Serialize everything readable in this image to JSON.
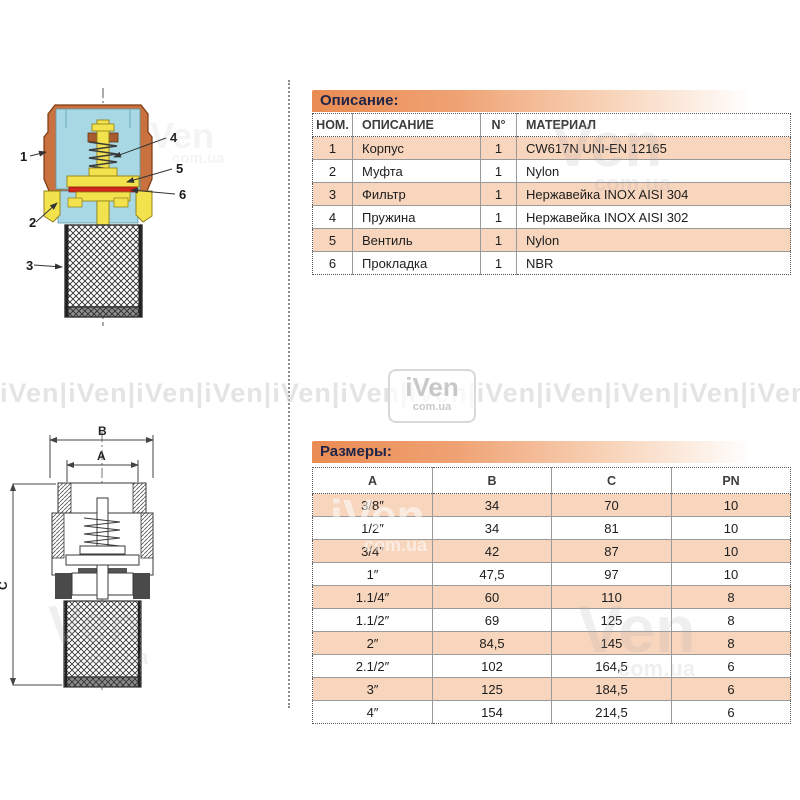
{
  "watermark": {
    "brand": "iVen",
    "short": "Ven",
    "domain": "com.ua",
    "band": "iVen|iVen|iVen|iVen|iVen|iVen|iVen|iVen|iVen|iVen|iVen|iVen|iVen|iVen"
  },
  "colors": {
    "accent_orange": "#ea8c53",
    "row_highlight": "#f8d5bd",
    "body_orange": "#c9723f",
    "interior_cyan": "#a7d8e4",
    "part_yellow": "#f2e24e",
    "gasket_red": "#d0281c",
    "title_text": "#202548"
  },
  "description_section": {
    "title": "Описание:",
    "table": {
      "columns": [
        "НОМ.",
        "ОПИСАНИЕ",
        "N°",
        "МАТЕРИАЛ"
      ],
      "rows": [
        [
          "1",
          "Корпус",
          "1",
          "CW617N UNI-EN 12165"
        ],
        [
          "2",
          "Муфта",
          "1",
          "Nylon"
        ],
        [
          "3",
          "Фильтр",
          "1",
          "Нержавейка INOX AISI 304"
        ],
        [
          "4",
          "Пружина",
          "1",
          "Нержавейка INOX AISI 302"
        ],
        [
          "5",
          "Вентиль",
          "1",
          "Nylon"
        ],
        [
          "6",
          "Прокладка",
          "1",
          "NBR"
        ]
      ]
    }
  },
  "dimensions_section": {
    "title": "Размеры:",
    "table": {
      "columns": [
        "A",
        "B",
        "C",
        "PN"
      ],
      "rows": [
        [
          "3/8″",
          "34",
          "70",
          "10"
        ],
        [
          "1/2″",
          "34",
          "81",
          "10"
        ],
        [
          "3/4″",
          "42",
          "87",
          "10"
        ],
        [
          "1″",
          "47,5",
          "97",
          "10"
        ],
        [
          "1.1/4″",
          "60",
          "110",
          "8"
        ],
        [
          "1.1/2″",
          "69",
          "125",
          "8"
        ],
        [
          "2″",
          "84,5",
          "145",
          "8"
        ],
        [
          "2.1/2″",
          "102",
          "164,5",
          "6"
        ],
        [
          "3″",
          "125",
          "184,5",
          "6"
        ],
        [
          "4″",
          "154",
          "214,5",
          "6"
        ]
      ]
    }
  },
  "cutaway_diagram": {
    "callouts": [
      "1",
      "2",
      "3",
      "4",
      "5",
      "6"
    ]
  },
  "dimension_diagram": {
    "labels": [
      "B",
      "A",
      "C"
    ]
  }
}
